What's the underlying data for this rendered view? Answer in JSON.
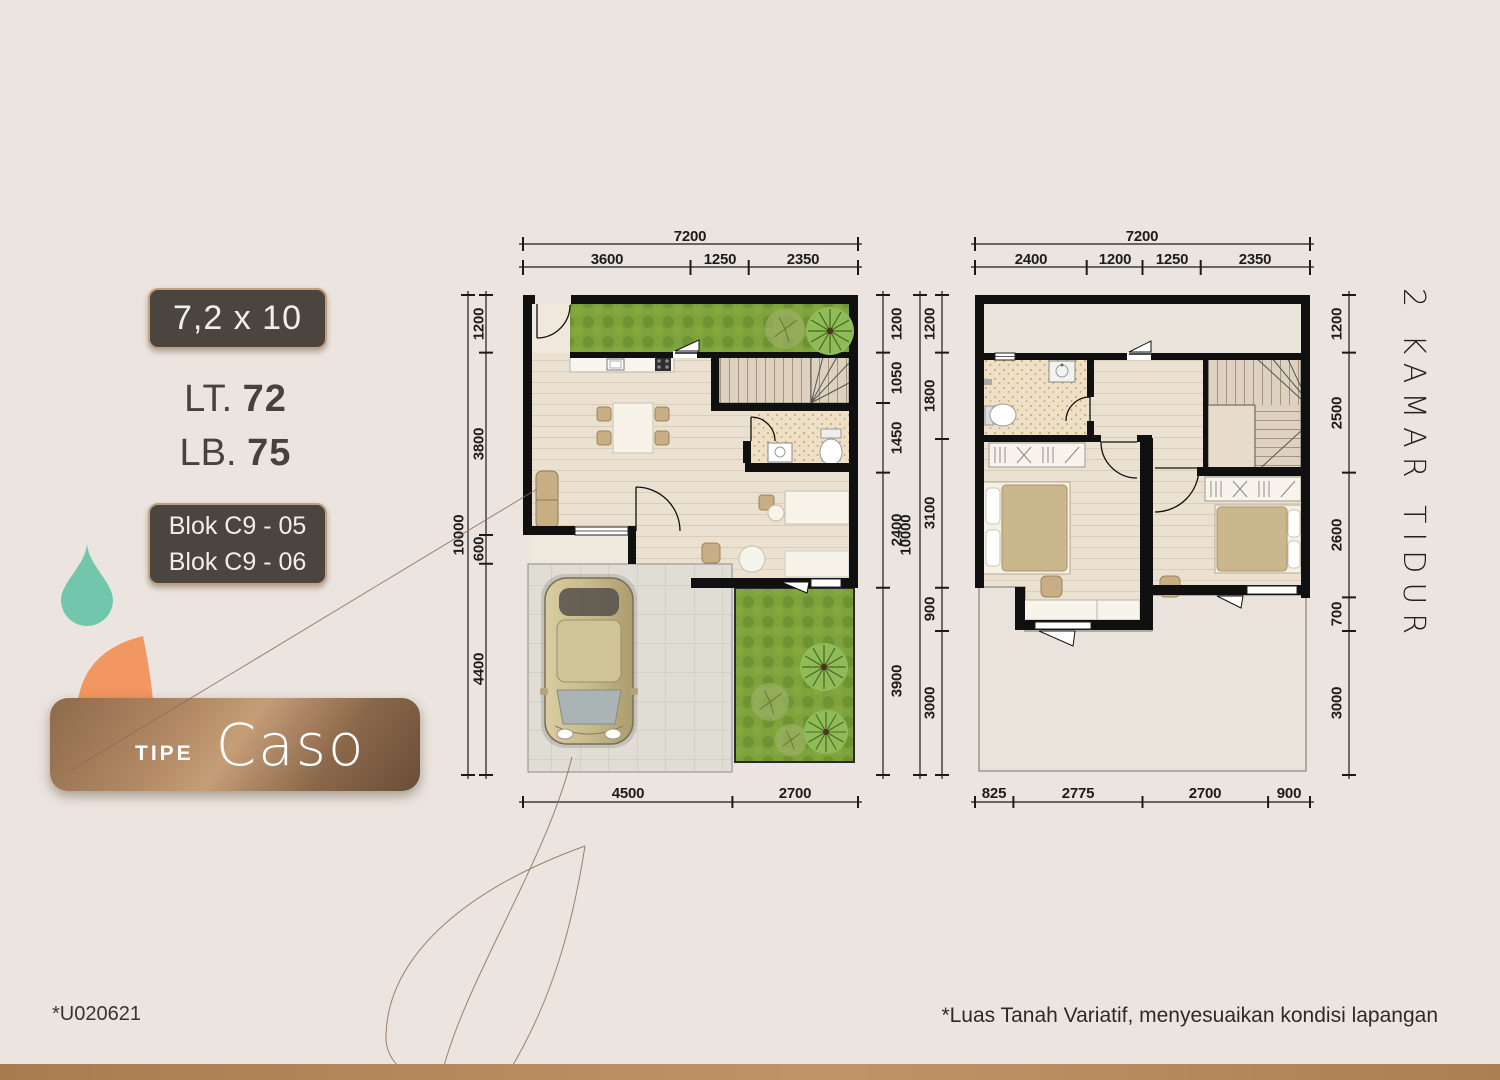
{
  "info_panel": {
    "size_badge": "7,2 x 10",
    "land_area": {
      "label": "LT.",
      "value": "72"
    },
    "building_area": {
      "label": "LB.",
      "value": "75"
    },
    "blocks": [
      "Blok C9 - 05",
      "Blok C9 - 06"
    ],
    "type": {
      "label": "TIPE",
      "value": "Caso"
    }
  },
  "side_note": "2 KAMAR TIDUR",
  "footer": {
    "code": "*U020621",
    "disclaimer": "*Luas Tanah Variatif, menyesuaikan kondisi lapangan"
  },
  "floor_plans": {
    "ground_floor": {
      "width_total": "7200",
      "height_total": "10000",
      "top_segments": [
        "3600",
        "1250",
        "2350"
      ],
      "left_segments": [
        "1200",
        "3800",
        "600",
        "4400"
      ],
      "right_segments": [
        "1200",
        "1050",
        "1450",
        "2400",
        "3900"
      ],
      "bottom_segments": [
        "4500",
        "2700"
      ]
    },
    "upper_floor": {
      "width_total": "7200",
      "height_total": "10000",
      "top_segments": [
        "2400",
        "1200",
        "1250",
        "2350"
      ],
      "left_segments": [
        "1200",
        "1800",
        "3100",
        "900",
        "3000"
      ],
      "right_segments": [
        "1200",
        "2500",
        "2600",
        "700",
        "3000"
      ],
      "bottom_segments": [
        "825",
        "2775",
        "2700",
        "900"
      ]
    }
  },
  "colors": {
    "background": "#ece5df",
    "badge_bg": "#4b4540",
    "badge_border": "#c2a183",
    "banner_brown": "#8d6a4d",
    "teal_drop": "#72c6ac",
    "orange_petal": "#f29761",
    "grass_green": "#7ea23c",
    "wall_black": "#101010",
    "bottom_bar": "#b2854f"
  }
}
